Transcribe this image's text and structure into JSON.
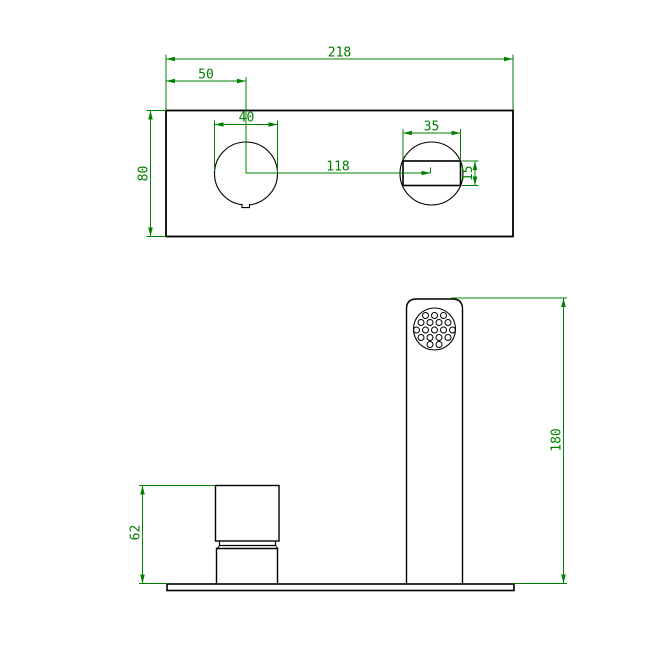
{
  "drawing": {
    "kind": "faucet-technical-drawing",
    "views": [
      "top-view-wall-plate",
      "front-view-spout-and-handle"
    ],
    "colors": {
      "dimension_color": "#008000",
      "outline_color": "#000000",
      "background_color": "#ffffff"
    },
    "dims": {
      "plate_width": "218",
      "handle_offset": "50",
      "handle_hole_diameter": "40",
      "hole_spacing": "118",
      "plate_height": "80",
      "spout_hole_width": "35",
      "spout_slot_height": "15",
      "spout_height": "180",
      "handle_height": "62"
    }
  }
}
